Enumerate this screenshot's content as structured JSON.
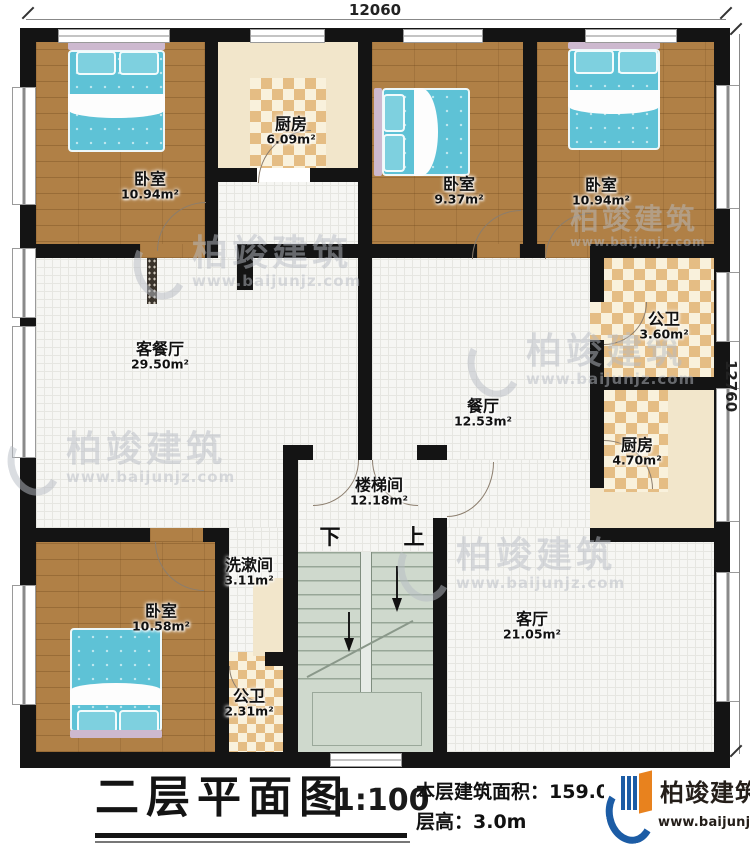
{
  "plan": {
    "dim_top": "12060",
    "dim_right": "12760",
    "rooms": [
      {
        "id": "bedroom-top-left",
        "name": "卧室",
        "area": "10.94m²"
      },
      {
        "id": "kitchen-top",
        "name": "厨房",
        "area": "6.09m²"
      },
      {
        "id": "bedroom-top-middle",
        "name": "卧室",
        "area": "9.37m²"
      },
      {
        "id": "bedroom-top-right",
        "name": "卧室",
        "area": "10.94m²"
      },
      {
        "id": "bath-right",
        "name": "公卫",
        "area": "3.60m²"
      },
      {
        "id": "kitchen-right",
        "name": "厨房",
        "area": "4.70m²"
      },
      {
        "id": "living-dining",
        "name": "客餐厅",
        "area": "29.50m²"
      },
      {
        "id": "dining",
        "name": "餐厅",
        "area": "12.53m²"
      },
      {
        "id": "stairwell",
        "name": "楼梯间",
        "area": "12.18m²"
      },
      {
        "id": "washroom",
        "name": "洗漱间",
        "area": "3.11m²"
      },
      {
        "id": "bath-bottom",
        "name": "公卫",
        "area": "2.31m²"
      },
      {
        "id": "bedroom-bottom-left",
        "name": "卧室",
        "area": "10.58m²"
      },
      {
        "id": "living-room",
        "name": "客厅",
        "area": "21.05m²"
      }
    ],
    "stairs": {
      "down": "下",
      "up": "上"
    }
  },
  "title_block": {
    "title": "二层平面图",
    "scale": "1:100",
    "area_line": "本层建筑面积：159.06m²",
    "height_line": "层高：3.0m"
  },
  "branding": {
    "company": "柏竣建筑",
    "website": "www.baijunjz.com"
  }
}
